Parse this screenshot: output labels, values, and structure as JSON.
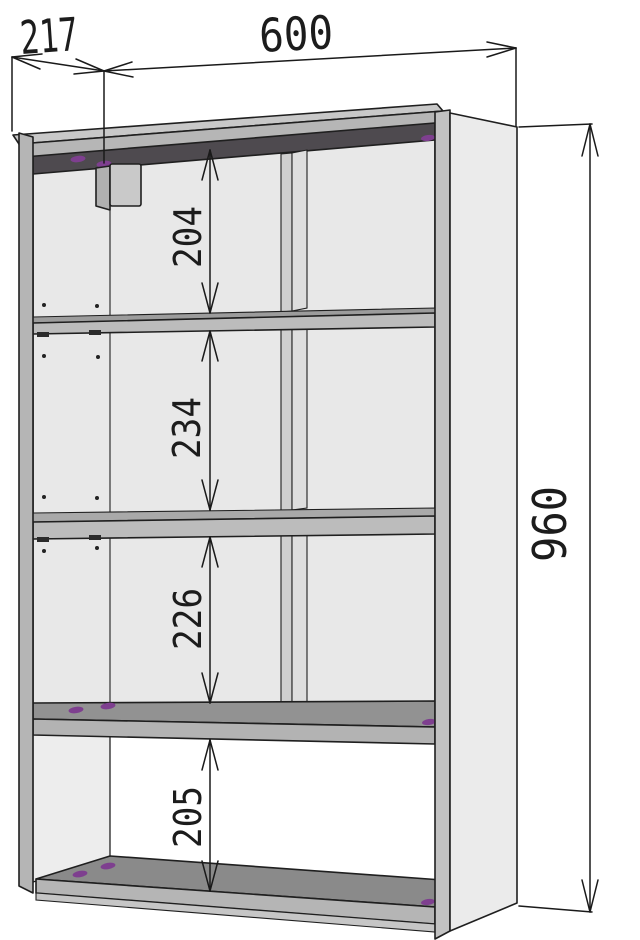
{
  "drawing": {
    "kind": "furniture-dimension-diagram",
    "object": "wall shelf unit with four openings",
    "labels": {
      "depth": "217",
      "width": "600",
      "height": "960",
      "gap_top": "204",
      "gap_second": "234",
      "gap_third": "226",
      "gap_bottom": "205"
    },
    "colors": {
      "line": "#1f1f1f",
      "back_panel": "#e8e8e8",
      "panel_edge_light": "#c8c8c8",
      "panel_edge_mid": "#b5b5b5",
      "top_underside_dark": "#4e4a4f",
      "shelf_top": "#949494",
      "bottom_top": "#8a8a8a",
      "right_side_face": "#ebebeb",
      "cam_lock_dot": "#7e3f8f"
    }
  }
}
